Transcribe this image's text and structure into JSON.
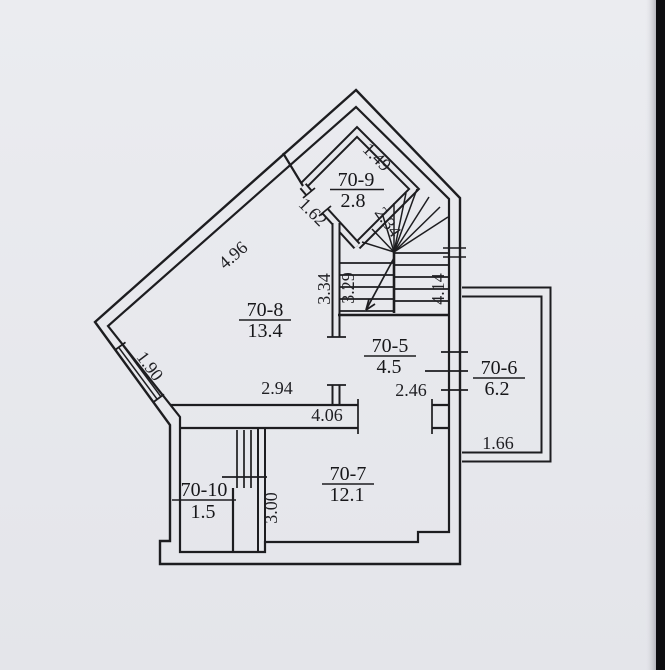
{
  "page": {
    "bg": "#e7e8ec",
    "ink": "#1d1d20",
    "edge": "#0d0d10"
  },
  "rooms": {
    "r709": {
      "label": "70-9",
      "area": "2.8"
    },
    "r708": {
      "label": "70-8",
      "area": "13.4"
    },
    "r705": {
      "label": "70-5",
      "area": "4.5"
    },
    "r706": {
      "label": "70-6",
      "area": "6.2"
    },
    "r707": {
      "label": "70-7",
      "area": "12.1"
    },
    "r7010": {
      "label": "70-10",
      "area": "1.5"
    }
  },
  "dimensions": {
    "d149": "1.49",
    "d162": "1.62",
    "d234": "2.34",
    "d496": "4.96",
    "d334": "3.34",
    "d329": "3.29",
    "d414": "4.14",
    "d190": "1.90",
    "d294": "2.94",
    "d246": "2.46",
    "d406": "4.06",
    "d166": "1.66",
    "d300": "3.00"
  }
}
